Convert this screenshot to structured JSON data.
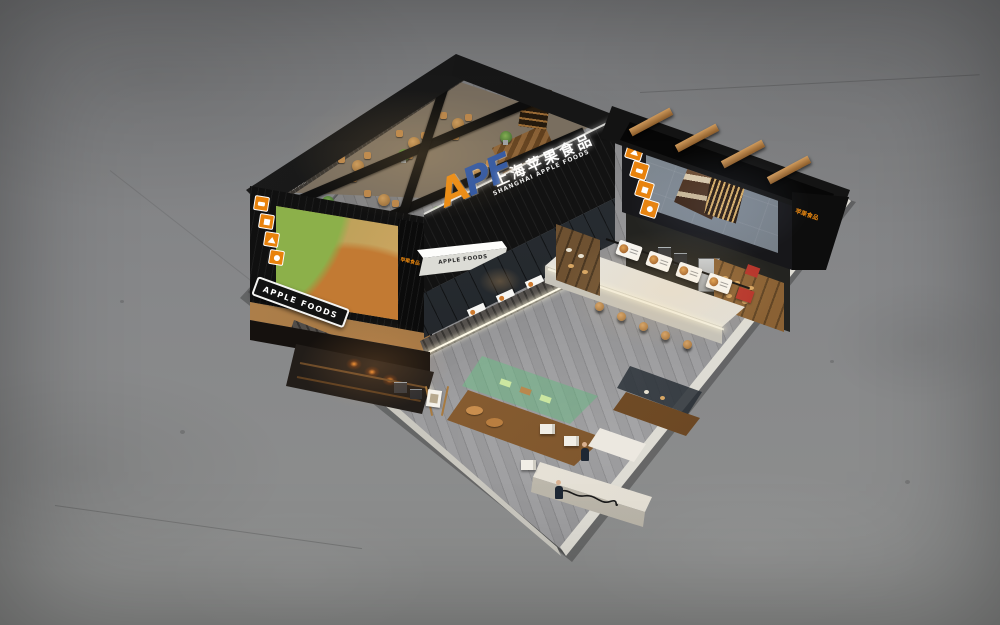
{
  "branding": {
    "monogram_a": "A",
    "monogram_pf": "PF",
    "name_cn": "上海苹果食品",
    "name_en": "SHANGHAI APPLE FOODS",
    "awning_label": "APPLE FOODS",
    "side_sign_label": "APPLE FOODS",
    "interior_wall_cn": "上海苹果食品",
    "interior_wall_en": "SHANGHAI APPLE FOODS",
    "corner_tag_cn": "苹果食品"
  },
  "icons": {
    "left_strip": [
      "bread-icon",
      "meat-icon",
      "fish-icon",
      "apple-icon"
    ],
    "screen_strip": [
      "house-icon",
      "cow-icon",
      "fish-icon",
      "apple-icon"
    ],
    "led_screen_subject": "cake-slice-image",
    "left_billboard_subject": "food-collage-image"
  },
  "colors": {
    "accent_orange": "#e8820c",
    "logo_blue": "#2c55a5",
    "structure_black": "#141414",
    "wood": "#a8723c",
    "booth_floor_gray": "#8f8f92",
    "concrete_gray": "#85878a"
  }
}
